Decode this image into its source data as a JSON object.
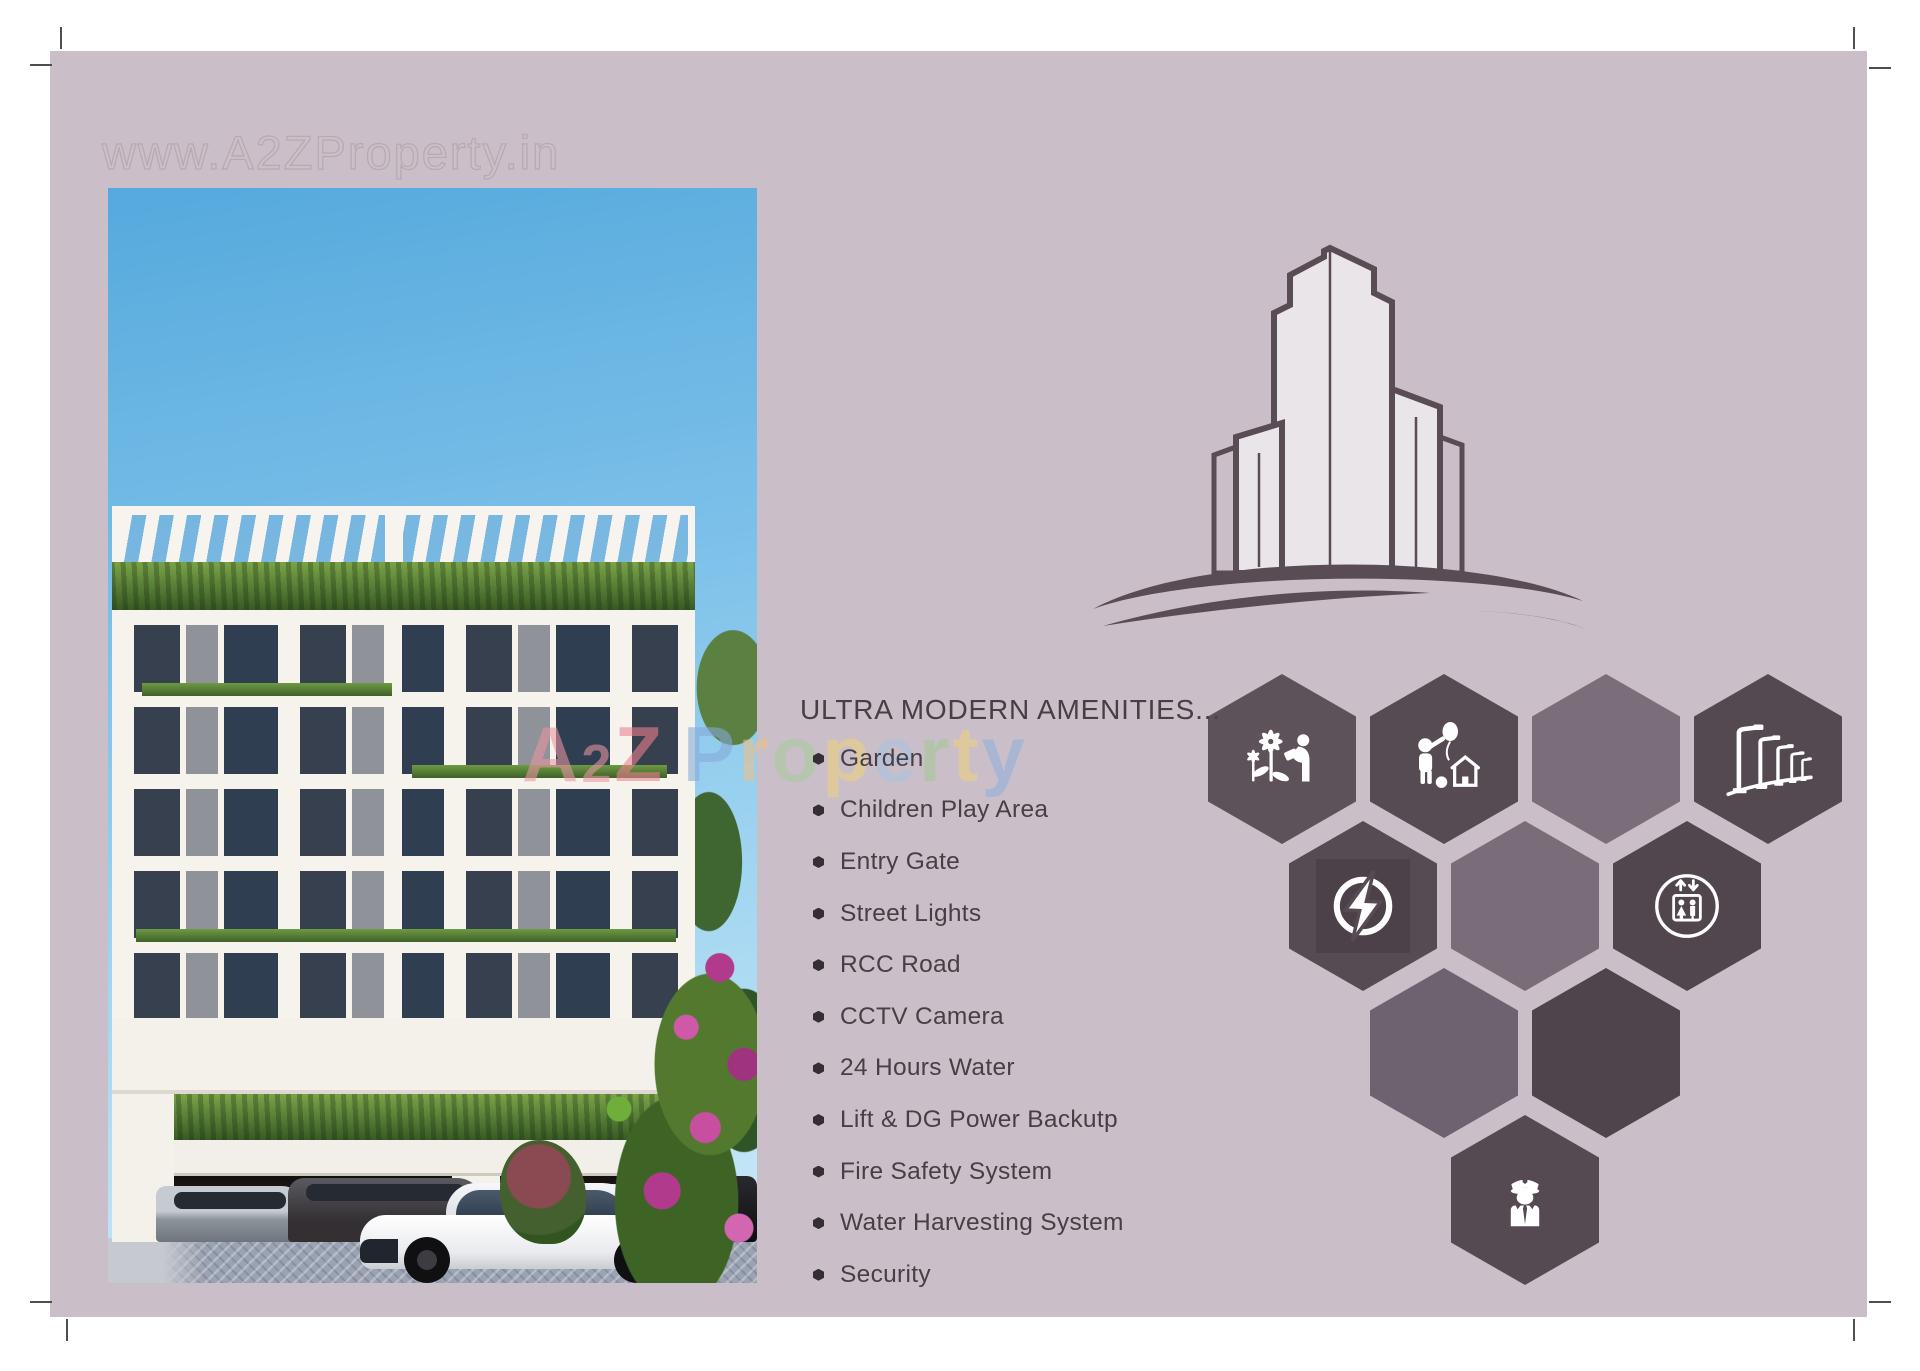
{
  "watermarks": {
    "top": "www.A2ZProperty.in",
    "brand_letters": [
      {
        "ch": "A",
        "color": "#ea96a4"
      },
      {
        "ch": "2",
        "color": "#ea96a4",
        "small": true
      },
      {
        "ch": "Z",
        "color": "#ee8190"
      },
      {
        "ch": "P",
        "color": "#86a9d9",
        "space_before": true
      },
      {
        "ch": "r",
        "color": "#eec088"
      },
      {
        "ch": "o",
        "color": "#a6cb9d"
      },
      {
        "ch": "p",
        "color": "#ecd17e"
      },
      {
        "ch": "e",
        "color": "#a9c2e2"
      },
      {
        "ch": "r",
        "color": "#a3c997"
      },
      {
        "ch": "t",
        "color": "#ecd17e"
      },
      {
        "ch": "y",
        "color": "#90b1dd"
      }
    ]
  },
  "amenities": {
    "heading": "ULTRA MODERN AMENITIES...",
    "items": [
      "Garden",
      "Children Play Area",
      "Entry Gate",
      "Street Lights",
      "RCC Road",
      "CCTV Camera",
      "24 Hours Water",
      "Lift & DG Power Backutp",
      "Fire Safety System",
      "Water Harvesting System",
      "Security"
    ]
  },
  "hexagons": [
    {
      "pos": "r1c1",
      "icon": "garden",
      "tone": "#5e525a",
      "name": "garden"
    },
    {
      "pos": "r1c2",
      "icon": "children",
      "tone": "#574b53",
      "name": "children-play-area"
    },
    {
      "pos": "r1c3",
      "icon": null,
      "tone": "#7b6e7a",
      "name": "empty-tile"
    },
    {
      "pos": "r1c4",
      "icon": "streetlights",
      "tone": "#544851",
      "name": "street-lights"
    },
    {
      "pos": "r2c1",
      "icon": "power",
      "tone": "#574b53",
      "name": "power-backup"
    },
    {
      "pos": "r2c2",
      "icon": null,
      "tone": "#7a6d79",
      "name": "empty-tile"
    },
    {
      "pos": "r2c3",
      "icon": "lift",
      "tone": "#51454e",
      "name": "lift"
    },
    {
      "pos": "r3c1",
      "icon": null,
      "tone": "#6f6270",
      "name": "empty-tile"
    },
    {
      "pos": "r3c2",
      "icon": null,
      "tone": "#4f434c",
      "name": "empty-tile"
    },
    {
      "pos": "r4c1",
      "icon": "security",
      "tone": "#554952",
      "name": "security"
    }
  ],
  "colors": {
    "background": "#cabfc8",
    "text": "#473e46",
    "bullet": "#352e35",
    "logo_stroke": "#5a4c55",
    "logo_fill": "#eae5e9",
    "hex_dark": "#544851",
    "hex_light": "#7b6e7a",
    "icon_white": "#ffffff"
  }
}
